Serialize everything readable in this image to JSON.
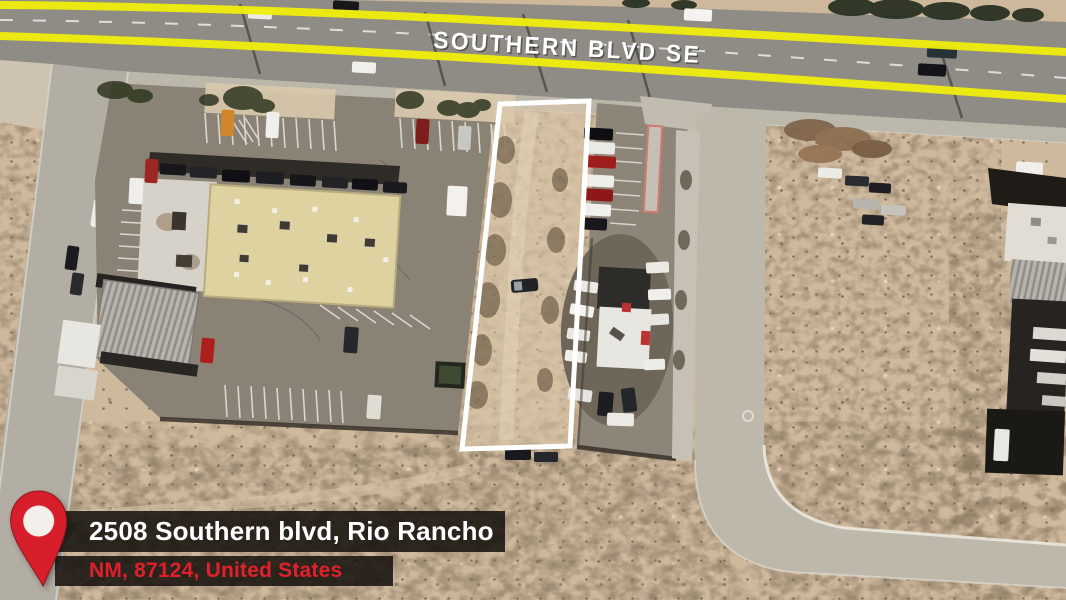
{
  "map": {
    "road_label": "SOUTHERN BLVD SE",
    "road_edge_color": "#f0ee0b",
    "parcel_outline_color": "#ffffff"
  },
  "address_card": {
    "line1": "2508 Southern blvd, Rio Rancho",
    "line2": "NM, 87124, United States",
    "line2_color": "#e2202b",
    "card_background": "rgba(18,14,11,0.85)",
    "pin_icon": "location-pin-icon",
    "pin_color": "#d71f2c"
  },
  "colors": {
    "desert_sand": "#cfb99d",
    "asphalt": "#8f8c85",
    "concrete": "#bcb7ab",
    "beige_roof": "#ded2a0",
    "white_roof": "#e8e6e1"
  }
}
